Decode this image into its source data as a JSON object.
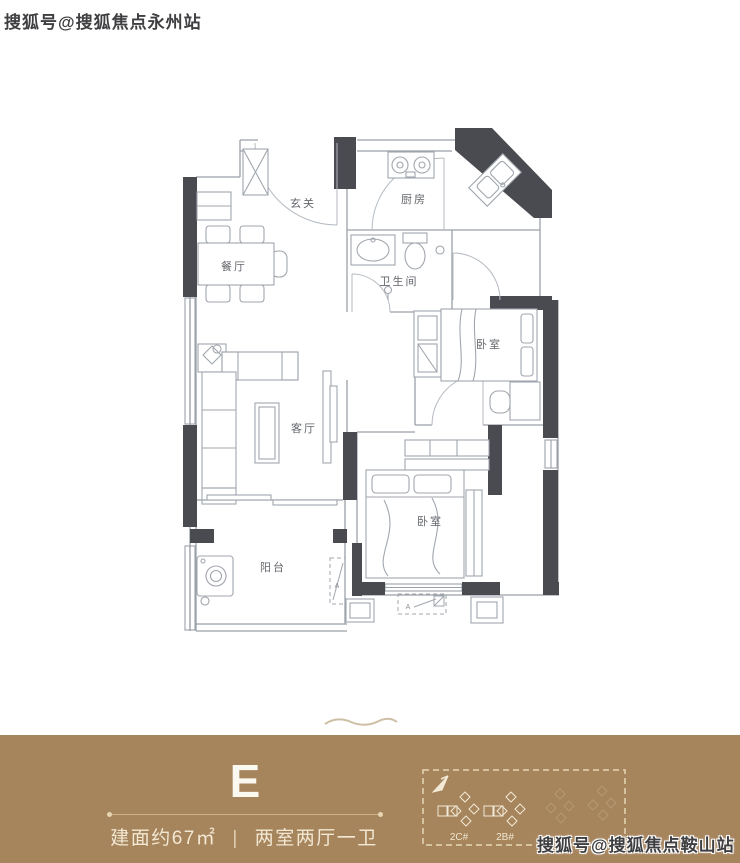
{
  "watermarks": {
    "top_left": "搜狐号@搜狐焦点永州站",
    "bottom_right": "搜狐号@搜狐焦点鞍山站"
  },
  "floorplan": {
    "rooms": {
      "entry": "玄关",
      "kitchen": "厨房",
      "dining": "餐厅",
      "bathroom": "卫生间",
      "bedroom_top": "卧室",
      "living": "客厅",
      "bedroom_bottom": "卧室",
      "balcony": "阳台"
    },
    "ac_mark": "A"
  },
  "info_band": {
    "unit_label": "E",
    "area_text": "建面约67㎡",
    "separator": "|",
    "layout_text": "两室两厅一卫",
    "site_plan": {
      "building_labels": [
        "2C#",
        "2B#"
      ]
    }
  },
  "colors": {
    "band_bg": "#a6845c",
    "band_text": "#f2e8d4",
    "unit_text": "#fbf8f0",
    "wall": "#4a4b50",
    "plan_line": "#9ba1a9",
    "site_bright": "#f2e9d6",
    "site_faint": "#b79a72"
  }
}
